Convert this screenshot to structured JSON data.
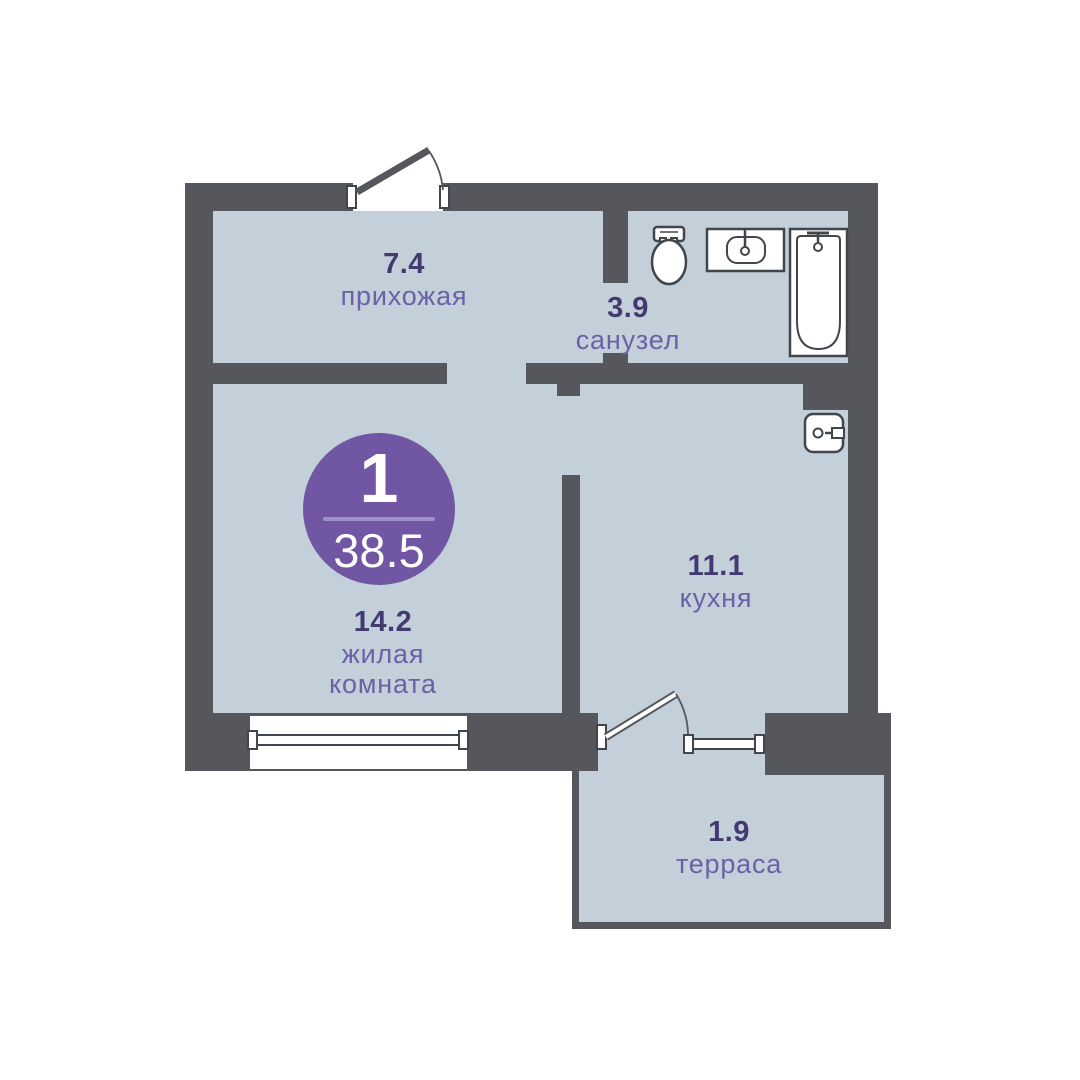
{
  "floor_plan": {
    "badge": {
      "room_count": "1",
      "total_area": "38.5"
    },
    "rooms": {
      "hallway": {
        "area": "7.4",
        "name": "прихожая"
      },
      "bathroom": {
        "area": "3.9",
        "name": "санузел"
      },
      "living": {
        "area": "14.2",
        "name_line1": "жилая",
        "name_line2": "комната"
      },
      "kitchen": {
        "area": "11.1",
        "name": "кухня"
      },
      "terrace": {
        "area": "1.9",
        "name": "терраса"
      }
    },
    "fixtures": [
      "toilet-icon",
      "sink-icon",
      "bathtub-icon",
      "water-heater-icon",
      "entrance-door-icon",
      "balcony-door-icon",
      "window-icon"
    ],
    "colors": {
      "background": "#ffffff",
      "wall": "#55575c",
      "floor": "#c3d0d9",
      "badge": "#7156a4",
      "badge_divider": "#a18fc9",
      "badge_text": "#ffffff",
      "area_text": "#443a72",
      "room_text": "#6a61a6",
      "fixture_outline": "#41464d"
    }
  }
}
